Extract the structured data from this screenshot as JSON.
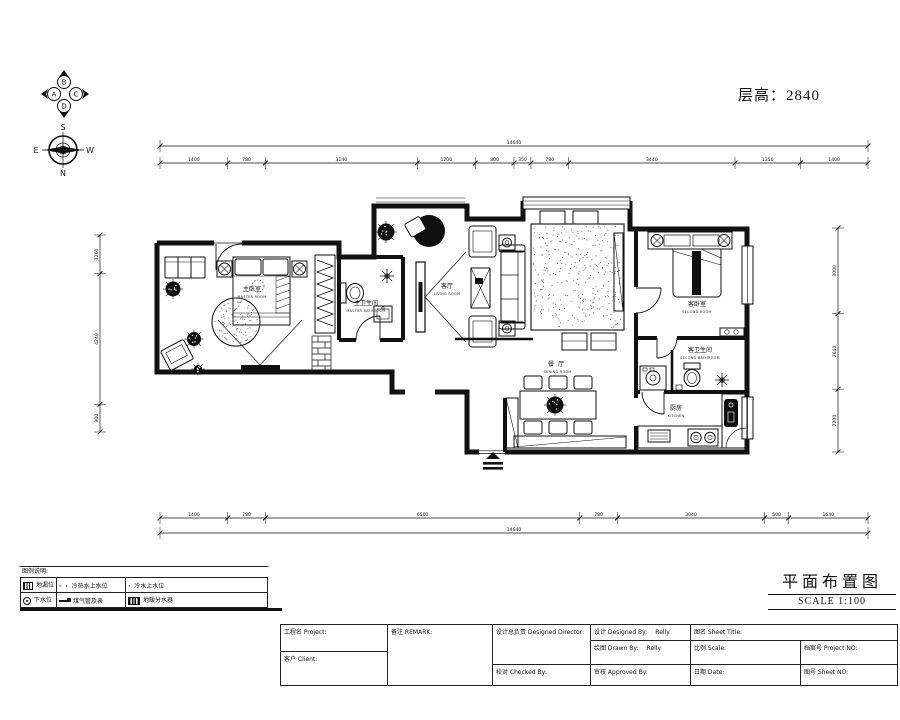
{
  "header": {
    "floor_height_label": "层高：2840"
  },
  "compass": {
    "quad_left": "A",
    "quad_top": "B",
    "quad_right": "C",
    "quad_bottom": "D",
    "top": "S",
    "left": "E",
    "right": "W",
    "bottom": "N"
  },
  "rooms": {
    "master_bedroom": {
      "zh": "主卧室",
      "en": "MASTER ROOM"
    },
    "master_bath": {
      "zh": "主卫生间",
      "en": "MASTER BATHROOM"
    },
    "living": {
      "zh": "客厅",
      "en": "LIVING ROOM"
    },
    "dining": {
      "zh": "餐厅",
      "en": "DINING ROOM"
    },
    "second_bedroom": {
      "zh": "客卧室",
      "en": "SECOND ROOM"
    },
    "second_bath": {
      "zh": "客卫生间",
      "en": "SECOND BATHROOM"
    },
    "kitchen": {
      "zh": "厨房",
      "en": "KITCHEN"
    }
  },
  "dimensions": {
    "top": {
      "segments": [
        1400,
        780,
        3140,
        1200,
        800,
        350,
        780,
        3440,
        1350,
        1400
      ],
      "total": "14640"
    },
    "bottom": {
      "segments": [
        1400,
        780,
        6500,
        780,
        3040,
        500,
        1640
      ],
      "total": "14640"
    },
    "left": {
      "segments": [
        1260,
        4240,
        900
      ]
    },
    "right": {
      "segments": [
        3000,
        2640,
        2200
      ]
    }
  },
  "legend": {
    "title": "图例说明:",
    "rows": [
      [
        {
          "label": "地漏位"
        },
        {
          "label": "冷热水上水位"
        },
        {
          "label": "冷水上水位"
        }
      ],
      [
        {
          "label": "下水位"
        },
        {
          "label": "煤气管及表"
        },
        {
          "label": "地暖分水器"
        }
      ]
    ],
    "dot_double": "· ·",
    "dot_single": "·"
  },
  "sheet": {
    "name": "平面布置图",
    "scale": "SCALE 1:100"
  },
  "titleblock": {
    "project_label": "工程名 Project:",
    "client_label": "客户 Client:",
    "remark_label": "备注 REMARK:",
    "director_label": "设计总负责 Designed Director:",
    "checked_label": "校对 Checked By:",
    "designed_label": "设计 Designed By:",
    "designed_value": "Relly",
    "drawn_label": "绘图 Drawn By:",
    "drawn_value": "Relly",
    "approved_label": "审核 Approved By:",
    "sheet_title_label": "图名 Sheet Title:",
    "scale_label": "比例 Scale:",
    "date_label": "日期 Date:",
    "project_no_label": "档案号 Project NO:",
    "sheet_no_label": "图号 Sheet NO:"
  },
  "colors": {
    "line": "#111111",
    "fill_dark": "#101010",
    "speckle": "#666666"
  }
}
